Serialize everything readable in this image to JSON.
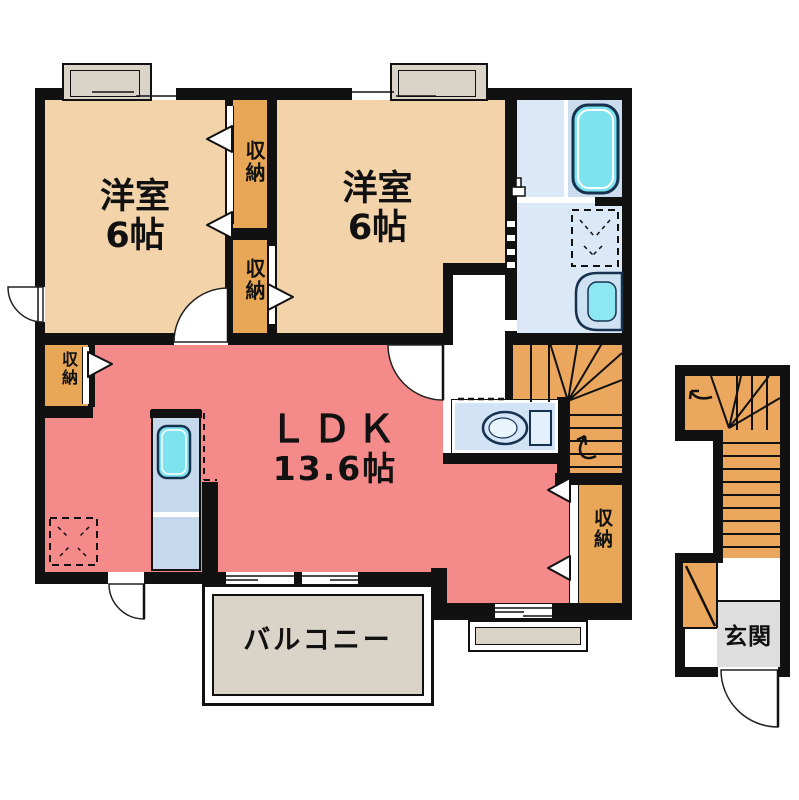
{
  "floor_plan": {
    "rooms": [
      {
        "id": "bedroom-1",
        "label": "洋室",
        "size": "6帖"
      },
      {
        "id": "bedroom-2",
        "label": "洋室",
        "size": "6帖"
      },
      {
        "id": "ldk",
        "label": "ＬＤＫ",
        "size": "13.6帖"
      },
      {
        "id": "balcony",
        "label": "バルコニー"
      },
      {
        "id": "entrance",
        "label": "玄関"
      }
    ],
    "closet_label": "収納",
    "colors": {
      "wall": "#111111",
      "bedroom_floor": "#f3d3a9",
      "closet_floor": "#e7a757",
      "stairs_floor": "#eaa75d",
      "ldk_floor": "#f48a8a",
      "bath_floor": "#dae8f8",
      "bath_tub_room_floor": "#cbdcee",
      "toilet_room_floor": "#d3e3f6",
      "fixture_cyan": "#7de4ef",
      "balcony_floor": "#dad4c8",
      "entrance_floor": "#dedede"
    }
  }
}
